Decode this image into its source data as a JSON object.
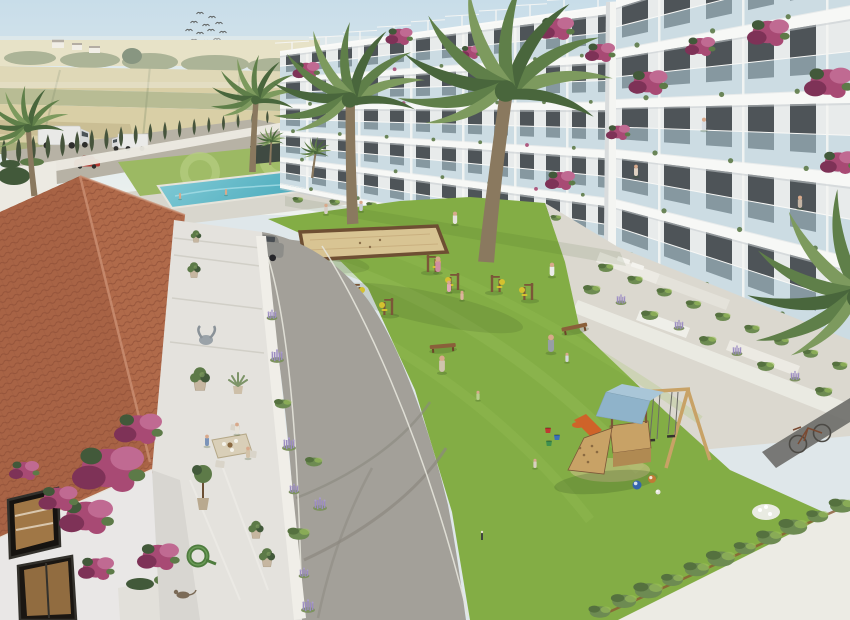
{
  "scene": {
    "title": "Aerial 3D architectural rendering of a Mediterranean residential complex: white apartment blocks with glass balconies around a green courtyard with playground, petanque court, outdoor gym, swimming pool, palm trees and a tiled-roof villa terrace in the foreground",
    "style": "computer generated visualization, bright daylight",
    "areas": [
      "countryside fields",
      "perimeter road with vans",
      "cypress hedge",
      "pool garden",
      "apartment building left wing",
      "apartment building right wing",
      "courtyard lawn",
      "playground",
      "villa terrace"
    ]
  },
  "colors": {
    "sky_top": "#c8dde9",
    "sky_horizon": "#eef2ef",
    "haze": "#f3f3ee",
    "field_tan": "#d3c693",
    "field_tan_dark": "#bfb07c",
    "field_green": "#a8ad7c",
    "field_pale": "#e0d7ae",
    "treeline": "#7e8a5e",
    "cypress": "#46543c",
    "road_back": "#b7b2a5",
    "wall_white": "#eceae2",
    "pool_deck": "#d8d6cd",
    "pool_lawn": "#9cb963",
    "pool_lawn_light": "#b6cd80",
    "pool_water": "#4fadbe",
    "pool_water_light": "#84ccd7",
    "bld_wall": "#e8ebeb",
    "bld_slab": "#f7f8f6",
    "bld_shadow": "#c6cccf",
    "window": "#2c3237",
    "glass": "#b5cfdc",
    "pillar": "#f4f5f2",
    "bougainvillea": "#a84a74",
    "bougainvillea_dark": "#7e3257",
    "bougainvillea_light": "#c06a92",
    "foliage": "#5d7a48",
    "foliage_dark": "#42593a",
    "lawn": "#83ad45",
    "lawn_light": "#9cc25c",
    "lawn_shadow": "#2f4a1e",
    "sand": "#d8c493",
    "sand_border": "#6e4f33",
    "wood": "#7b5638",
    "wood_light": "#c8a266",
    "accent_yellow": "#d4c12f",
    "play_roof": "#8fb3ca",
    "play_roof_light": "#a9c6d8",
    "slide_orange": "#cf6329",
    "stone": "#dbd8cf",
    "pavement": "#ecebe4",
    "path_dark": "#6f6f6b",
    "asphalt": "#a3a099",
    "asphalt_dark": "#8b887f",
    "kerb": "#e6e4db",
    "roof_tile": "#b06a4a",
    "roof_tile_dark": "#8e4f36",
    "roof_ridge": "#c98d70",
    "villa_wall": "#e9e7e6",
    "frame_dark": "#33312c",
    "interior_warm": "#b98a50",
    "terrace_stone": "#e4e2dd",
    "lavender": "#9b8cc0",
    "suv": "#8d8d89",
    "car_red": "#b23a33",
    "palm_trunk": "#8a795f",
    "palm_frond": "#5f7f49",
    "palm_frond_dark": "#49663c",
    "palm_frond_light": "#7d9a5e",
    "skin": "#d8a98b",
    "bench": "#8a5f3a",
    "bike": "#4c4a45",
    "hedge": "#6d8b52",
    "hedge_dark": "#55713f",
    "bloom_white": "#e9ebe2"
  },
  "objects": {
    "birds": [
      [
        200,
        14
      ],
      [
        212,
        18
      ],
      [
        194,
        23
      ],
      [
        206,
        26
      ],
      [
        219,
        24
      ],
      [
        189,
        31
      ],
      [
        200,
        34
      ],
      [
        211,
        31
      ],
      [
        223,
        33
      ],
      [
        194,
        41
      ],
      [
        206,
        42
      ],
      [
        217,
        40
      ]
    ],
    "cypress_row": {
      "count": 20,
      "x0": 4,
      "y0": 166,
      "x1": 282,
      "y1": 121,
      "h0": 27,
      "h1": 12
    },
    "buildings": {
      "left_wing": {
        "x0": 280,
        "x1": 625,
        "y_top0": 52,
        "y_top1": 4,
        "y_base0": 184,
        "y_base1": 250,
        "floors": 5,
        "win_step": 26,
        "win_w": 14,
        "slab0": 4,
        "slab1": 8
      },
      "right_wing": {
        "x0": 616,
        "x1": 851,
        "y_top0": 0,
        "y_top1": -78,
        "y_base0": 250,
        "y_base1": 342,
        "floors": 5,
        "win_step": 42,
        "win_w": 26,
        "slab0": 8,
        "slab1": 13
      }
    },
    "bougainvillea_building": [
      [
        306,
        70,
        0.9
      ],
      [
        348,
        92,
        0.8
      ],
      [
        399,
        36,
        0.9
      ],
      [
        470,
        52,
        0.7
      ],
      [
        556,
        28,
        1.2
      ],
      [
        600,
        52,
        1.0
      ],
      [
        648,
        82,
        1.3
      ],
      [
        700,
        46,
        1.0
      ],
      [
        768,
        32,
        1.4
      ],
      [
        828,
        82,
        1.6
      ],
      [
        838,
        162,
        1.2
      ],
      [
        560,
        180,
        1.0
      ],
      [
        618,
        132,
        0.8
      ]
    ],
    "bougainvillea_villa": [
      [
        108,
        468,
        2.4
      ],
      [
        86,
        516,
        1.8
      ],
      [
        138,
        428,
        1.6
      ],
      [
        58,
        498,
        1.3
      ],
      [
        158,
        556,
        1.4
      ],
      [
        24,
        470,
        1.0
      ],
      [
        96,
        568,
        1.2
      ]
    ],
    "palms": [
      {
        "x": 252,
        "y": 172,
        "s": 0.9,
        "r": 0,
        "label": "background-palm"
      },
      {
        "x": 34,
        "y": 196,
        "s": 0.85,
        "r": -8,
        "label": "far-left-palm"
      },
      {
        "x": 270,
        "y": 165,
        "s": 0.3,
        "r": 0,
        "label": "pool-palm-1"
      },
      {
        "x": 312,
        "y": 178,
        "s": 0.32,
        "r": 5,
        "label": "pool-palm-2"
      },
      {
        "x": 352,
        "y": 224,
        "s": 1.55,
        "r": -4,
        "label": "courtyard-palm-left"
      },
      {
        "x": 485,
        "y": 262,
        "s": 2.15,
        "r": 4,
        "label": "courtyard-palm-big"
      },
      {
        "x": 895,
        "y": 470,
        "s": 2.2,
        "r": -15,
        "label": "right-edge-palm"
      }
    ],
    "people": [
      {
        "x": 438,
        "y": 272,
        "h": 15,
        "c": "#cf8fa2",
        "layer": "lawn",
        "label": "woman-pink"
      },
      {
        "x": 449,
        "y": 292,
        "h": 11,
        "c": "#e2aab6",
        "layer": "lawn",
        "label": "girl-pink"
      },
      {
        "x": 462,
        "y": 300,
        "h": 9,
        "c": "#dcb49e",
        "layer": "lawn",
        "label": "toddler"
      },
      {
        "x": 442,
        "y": 372,
        "h": 16,
        "c": "#cfc4ad",
        "layer": "lawn",
        "label": "man-carrying-plank"
      },
      {
        "x": 478,
        "y": 400,
        "h": 9,
        "c": "#b9cf8e",
        "layer": "lawn",
        "label": "toddler-green"
      },
      {
        "x": 551,
        "y": 352,
        "h": 17,
        "c": "#979ea6",
        "layer": "lawn",
        "label": "adult-grey-hoodie"
      },
      {
        "x": 567,
        "y": 362,
        "h": 9,
        "c": "#d4d8dc",
        "layer": "lawn",
        "label": "toddler-white"
      },
      {
        "x": 535,
        "y": 468,
        "h": 9,
        "c": "#d8d0c0",
        "layer": "lawn",
        "label": "child-crouching"
      },
      {
        "x": 326,
        "y": 214,
        "h": 10,
        "c": "#d6cec6",
        "layer": "lawn",
        "label": "resident-1"
      },
      {
        "x": 361,
        "y": 211,
        "h": 10,
        "c": "#c6cad0",
        "layer": "lawn",
        "label": "resident-2"
      },
      {
        "x": 455,
        "y": 224,
        "h": 12,
        "c": "#e6e3dc",
        "layer": "lawn",
        "label": "walker-on-path"
      },
      {
        "x": 552,
        "y": 276,
        "h": 13,
        "c": "#ececea",
        "layer": "lawn",
        "label": "jogger"
      },
      {
        "x": 180,
        "y": 199,
        "h": 6,
        "c": "#d8a98b",
        "layer": "pool",
        "label": "swimmer-1"
      },
      {
        "x": 226,
        "y": 195,
        "h": 6,
        "c": "#d8a98b",
        "layer": "pool",
        "label": "swimmer-2"
      },
      {
        "x": 207,
        "y": 446,
        "h": 11,
        "c": "#7a93b8",
        "layer": "villa",
        "label": "diner-blue-shirt"
      },
      {
        "x": 237,
        "y": 434,
        "h": 11,
        "c": "#e6e2d8",
        "layer": "villa",
        "label": "diner-white-top"
      },
      {
        "x": 248,
        "y": 458,
        "h": 11,
        "c": "#d2c2a8",
        "layer": "villa",
        "label": "diner-beige"
      },
      {
        "x": 704,
        "y": 130,
        "h": 12,
        "c": "#d6dce2",
        "layer": "balcony",
        "label": "balcony-resident-1"
      },
      {
        "x": 636,
        "y": 176,
        "h": 11,
        "c": "#e0d2c2",
        "layer": "balcony",
        "label": "balcony-resident-2"
      },
      {
        "x": 800,
        "y": 208,
        "h": 12,
        "c": "#c4b4a4",
        "layer": "balcony",
        "label": "balcony-resident-3"
      }
    ],
    "benches": [
      {
        "x": 443,
        "y": 349,
        "r": -5
      },
      {
        "x": 575,
        "y": 330,
        "r": -12
      }
    ],
    "gym_stations": [
      {
        "x": 352,
        "y": 300
      },
      {
        "x": 392,
        "y": 315,
        "f": -1
      },
      {
        "x": 428,
        "y": 272
      },
      {
        "x": 458,
        "y": 290,
        "f": -1
      },
      {
        "x": 492,
        "y": 292
      },
      {
        "x": 532,
        "y": 300,
        "f": -1
      }
    ],
    "bollards": [
      [
        337,
        300
      ],
      [
        346,
        340
      ],
      [
        482,
        540
      ]
    ],
    "balls": [
      {
        "x": 637,
        "y": 485,
        "r": 4.5,
        "c": "#3565ad"
      },
      {
        "x": 652,
        "y": 479,
        "r": 4,
        "c": "#c07a35"
      },
      {
        "x": 658,
        "y": 492,
        "r": 2.5,
        "c": "#e8e6e0"
      }
    ],
    "buckets": [
      {
        "x": 548,
        "y": 432,
        "c": "#bf3a31"
      },
      {
        "x": 557,
        "y": 439,
        "c": "#3a70b8"
      },
      {
        "x": 549,
        "y": 445,
        "c": "#3f914f"
      }
    ],
    "villa_pots": [
      {
        "x": 196,
        "y": 246,
        "s": 0.55
      },
      {
        "x": 194,
        "y": 280,
        "s": 0.7
      },
      {
        "x": 200,
        "y": 390,
        "s": 1.05
      },
      {
        "x": 256,
        "y": 540,
        "s": 0.8
      },
      {
        "x": 267,
        "y": 568,
        "s": 0.85
      }
    ],
    "villa_agave": {
      "x": 238,
      "y": 392,
      "s": 1.0
    },
    "lavender_road": [
      [
        272,
        318
      ],
      [
        277,
        360
      ],
      [
        283,
        404
      ],
      [
        289,
        448
      ],
      [
        294,
        492
      ],
      [
        299,
        534
      ],
      [
        304,
        576
      ],
      [
        308,
        610
      ],
      [
        314,
        462
      ],
      [
        320,
        508
      ]
    ],
    "terrace_rows": [
      {
        "x0": 606,
        "y0": 268,
        "x1": 840,
        "y1": 366,
        "n": 9,
        "mix": "shrub",
        "s": 0.8
      },
      {
        "x0": 592,
        "y0": 290,
        "x1": 824,
        "y1": 392,
        "n": 9,
        "mix": "alt",
        "s": 0.9
      },
      {
        "x0": 298,
        "y0": 200,
        "x1": 556,
        "y1": 218,
        "n": 8,
        "mix": "shrub",
        "s": 0.55
      }
    ],
    "hedge_row": {
      "x0": 600,
      "y0": 612,
      "x1": 842,
      "y1": 506,
      "n": 11
    },
    "vehicles": [
      {
        "t": "van",
        "x": 38,
        "y": 126,
        "s": 1.25,
        "r": 0,
        "layer": "back",
        "label": "white-camper-van"
      },
      {
        "t": "truck",
        "x": 118,
        "y": 134,
        "s": 1.0,
        "r": 0,
        "layer": "back",
        "label": "box-truck"
      },
      {
        "t": "car",
        "x": 74,
        "y": 157,
        "s": 1.0,
        "r": 0,
        "layer": "back",
        "label": "red-car"
      },
      {
        "t": "suv",
        "x": 236,
        "y": 240,
        "s": 1.05,
        "r": 4,
        "layer": "main",
        "label": "grey-suv"
      }
    ]
  }
}
